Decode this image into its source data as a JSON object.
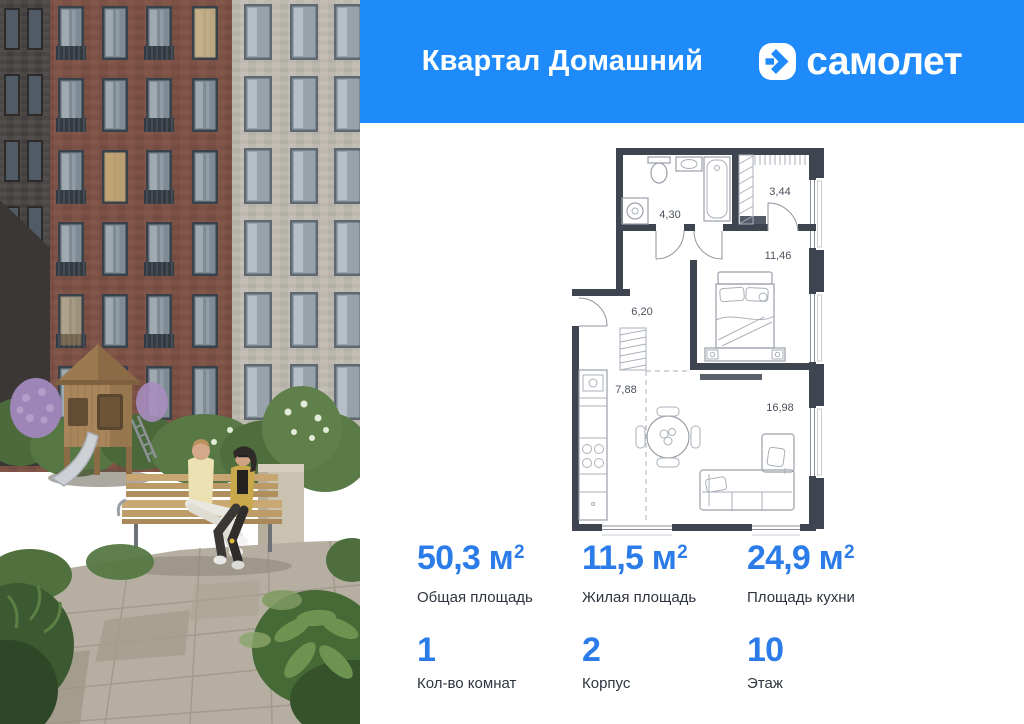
{
  "colors": {
    "header_blue": "#1f8bfa",
    "accent_blue": "#2b7ce9",
    "label_text": "#2f3540",
    "plan_walls": "#3e4450"
  },
  "header": {
    "project_name": "Квартал Домашний",
    "brand_name": "самолет"
  },
  "floorplan": {
    "areas": {
      "bathroom": "4,30",
      "dressing": "3,44",
      "hallway": "6,20",
      "bedroom": "11,46",
      "kitchen": "7,88",
      "living": "16,98"
    }
  },
  "stats": {
    "primary": [
      {
        "value": "50,3",
        "unit": "м",
        "sup": "2",
        "label": "Общая площадь"
      },
      {
        "value": "11,5",
        "unit": "м",
        "sup": "2",
        "label": "Жилая площадь"
      },
      {
        "value": "24,9",
        "unit": "м",
        "sup": "2",
        "label": "Площадь кухни"
      }
    ],
    "secondary": [
      {
        "value": "1",
        "label": "Кол-во комнат"
      },
      {
        "value": "2",
        "label": "Корпус"
      },
      {
        "value": "10",
        "label": "Этаж"
      }
    ]
  }
}
